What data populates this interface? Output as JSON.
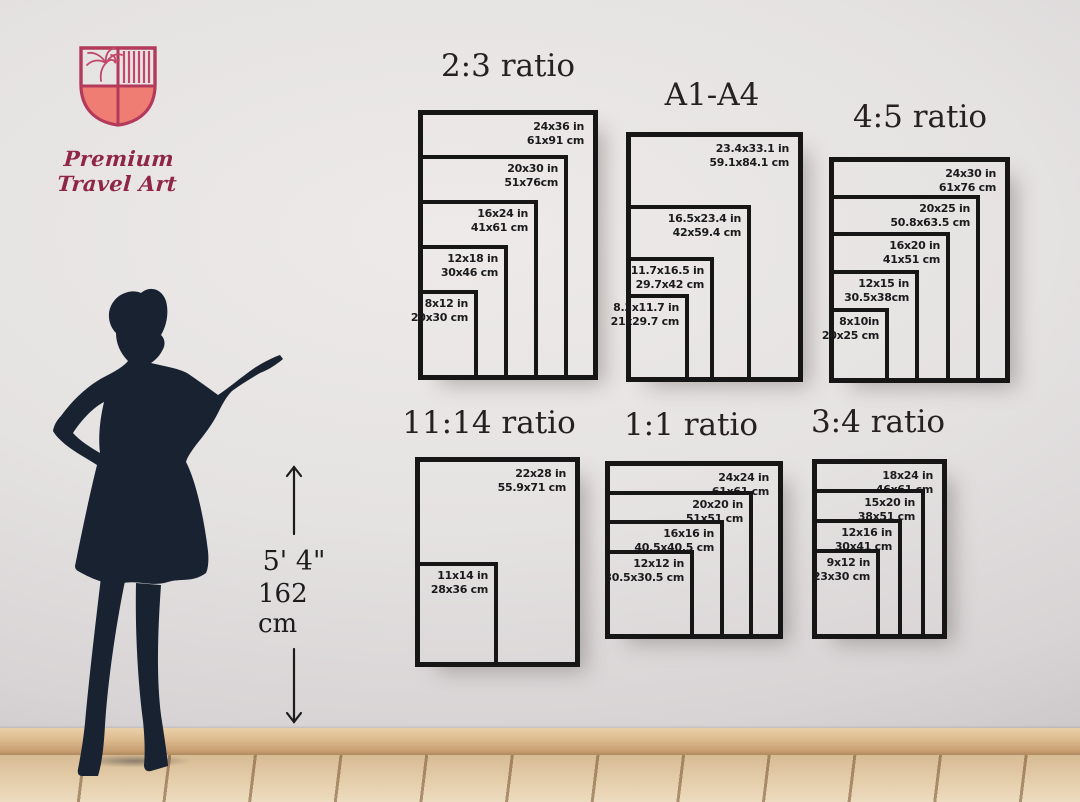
{
  "brand": {
    "name": "Premium Travel Art",
    "logo_colors": {
      "outline": "#b43a5c",
      "fill": "#ef7d74",
      "text": "#8f2647"
    }
  },
  "height_reference": {
    "feet": "5' 4\"",
    "cm": "162 cm"
  },
  "figure": "woman-silhouette",
  "frame_color": "#161616",
  "groups": [
    {
      "title": "2:3 ratio",
      "sizes": [
        {
          "inches": "24x36 in",
          "centimeters": "61x91 cm",
          "w": 24,
          "h": 36
        },
        {
          "inches": "20x30 in",
          "centimeters": "51x76cm",
          "w": 20,
          "h": 30
        },
        {
          "inches": "16x24 in",
          "centimeters": "41x61 cm",
          "w": 16,
          "h": 24
        },
        {
          "inches": "12x18 in",
          "centimeters": "30x46 cm",
          "w": 12,
          "h": 18
        },
        {
          "inches": "8x12 in",
          "centimeters": "20x30 cm",
          "w": 8,
          "h": 12
        }
      ]
    },
    {
      "title": "A1-A4",
      "sizes": [
        {
          "inches": "23.4x33.1 in",
          "centimeters": "59.1x84.1 cm",
          "w": 23.4,
          "h": 33.1
        },
        {
          "inches": "16.5x23.4 in",
          "centimeters": "42x59.4 cm",
          "w": 16.5,
          "h": 23.4
        },
        {
          "inches": "11.7x16.5 in",
          "centimeters": "29.7x42 cm",
          "w": 11.7,
          "h": 16.5
        },
        {
          "inches": "8.3x11.7 in",
          "centimeters": "21x29.7 cm",
          "w": 8.3,
          "h": 11.7
        }
      ]
    },
    {
      "title": "4:5 ratio",
      "sizes": [
        {
          "inches": "24x30 in",
          "centimeters": "61x76 cm",
          "w": 24,
          "h": 30
        },
        {
          "inches": "20x25 in",
          "centimeters": "50.8x63.5 cm",
          "w": 20,
          "h": 25
        },
        {
          "inches": "16x20 in",
          "centimeters": "41x51 cm",
          "w": 16,
          "h": 20
        },
        {
          "inches": "12x15 in",
          "centimeters": "30.5x38cm",
          "w": 12,
          "h": 15
        },
        {
          "inches": "8x10in",
          "centimeters": "20x25 cm",
          "w": 8,
          "h": 10
        }
      ]
    },
    {
      "title": "11:14 ratio",
      "sizes": [
        {
          "inches": "22x28 in",
          "centimeters": "55.9x71 cm",
          "w": 22,
          "h": 28
        },
        {
          "inches": "11x14 in",
          "centimeters": "28x36 cm",
          "w": 11,
          "h": 14
        }
      ]
    },
    {
      "title": "1:1 ratio",
      "sizes": [
        {
          "inches": "24x24 in",
          "centimeters": "61x61 cm",
          "w": 24,
          "h": 24
        },
        {
          "inches": "20x20 in",
          "centimeters": "51x51 cm",
          "w": 20,
          "h": 20
        },
        {
          "inches": "16x16 in",
          "centimeters": "40.5x40.5 cm",
          "w": 16,
          "h": 16
        },
        {
          "inches": "12x12 in",
          "centimeters": "30.5x30.5 cm",
          "w": 12,
          "h": 12
        }
      ]
    },
    {
      "title": "3:4 ratio",
      "sizes": [
        {
          "inches": "18x24 in",
          "centimeters": "46x61 cm",
          "w": 18,
          "h": 24
        },
        {
          "inches": "15x20 in",
          "centimeters": "38x51 cm",
          "w": 15,
          "h": 20
        },
        {
          "inches": "12x16 in",
          "centimeters": "30x41 cm",
          "w": 12,
          "h": 16
        },
        {
          "inches": "9x12 in",
          "centimeters": "23x30 cm",
          "w": 9,
          "h": 12
        }
      ]
    }
  ]
}
